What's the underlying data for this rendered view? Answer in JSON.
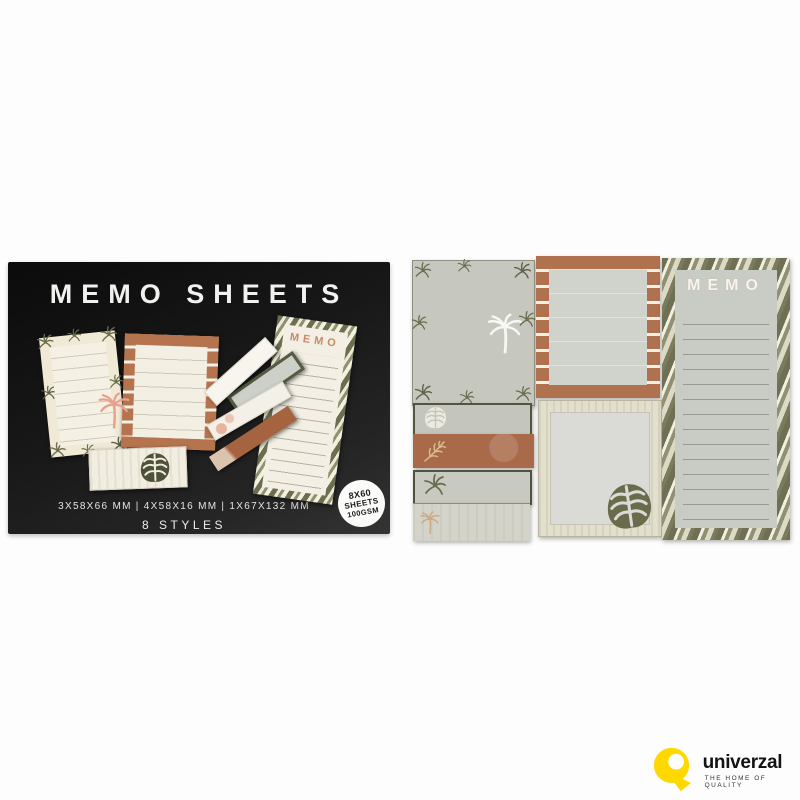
{
  "box": {
    "title": "MEMO SHEETS",
    "memo_pad_label": "MEMO",
    "dimensions_line": "3X58X66 MM | 4X58X16 MM | 1X67X132 MM",
    "styles_line": "8 STYLES",
    "badge": {
      "line1": "8X60",
      "line2": "SHEETS",
      "line3": "100GSM"
    }
  },
  "sheets": {
    "memo_pad_label": "MEMO"
  },
  "brand": {
    "name": "univerzal",
    "tagline": "THE HOME OF QUALITY"
  },
  "colors": {
    "background": "#ffffff",
    "box_black": "#161616",
    "cream": "#f2eee1",
    "copper": "#ae6f4c",
    "olive": "#6c6d50",
    "pad_gray": "#c8cac2",
    "line_gray": "#97978d",
    "brand_yellow": "#ffd800",
    "pink_leaf": "#e7a28d"
  },
  "icons": {
    "palm-frond-icon": "radiating palm fronds burst",
    "palm-tree-icon": "palm tree silhouette",
    "monstera-leaf-icon": "monstera leaf with slits",
    "fern-leaf-icon": "fern frond",
    "q-logo-icon": "yellow Q brand mark"
  }
}
